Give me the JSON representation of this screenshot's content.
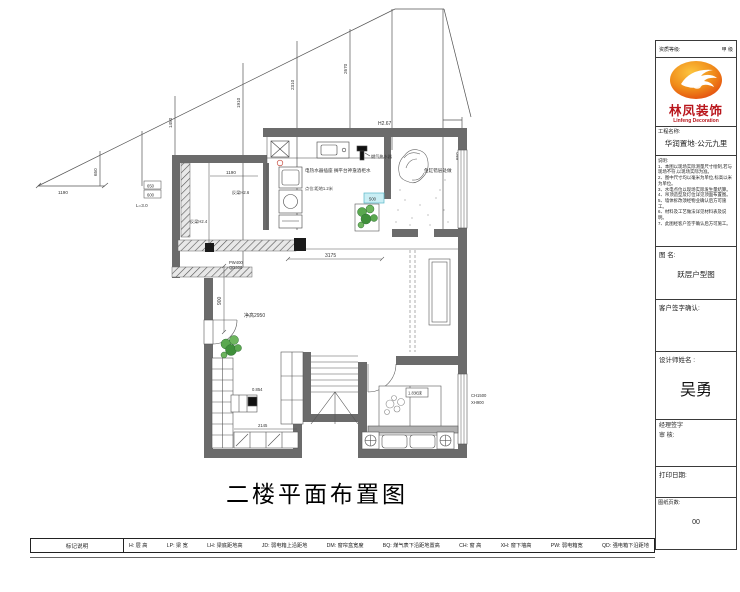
{
  "title": "二楼平面布置图",
  "titleblock": {
    "header_left": "资质等级:",
    "header_right": "甲 级",
    "logo_cn": "林凤装饰",
    "logo_en": "Linfeng Decoration",
    "project_label": "工程名称:",
    "project_name": "华润置地·公元九里",
    "notes_label": "说明:",
    "notes": [
      "1、本图以现场实际测量尺寸绘制,若与现场不符,以现场实际为准。",
      "2、图中尺寸均以毫米为单位,标高以米为单位。",
      "3、水电点位以现场实际发生量结算。",
      "4、吊顶造型及灯位详见顶面布置图。",
      "5、墙体拆改须经物业确认后方可施工。",
      "6、材料及工艺做法详见材料表及说明。",
      "7、此图经客户签字确认后方可施工。"
    ],
    "figname_label": "图 名:",
    "figname_value": "跃层户型图",
    "customer_label": "客户签字确认:",
    "designer_label": "设计师姓名 :",
    "designer_name": "吴勇",
    "manager_line1": "经理签字",
    "manager_line2": "审  核:",
    "print_label": "打印日期:",
    "pages_label": "图纸页数:",
    "pages_value": "00"
  },
  "legend": {
    "title": "标记说明",
    "items": [
      "H: 层  高",
      "LP: 梁  宽",
      "LH: 梁底距地高",
      "JD: 弱电箱上沿距地",
      "DM: 窗帘盒宽度",
      "BQ: 煤气表下沿距地置高",
      "CH: 窗  高",
      "XH: 窗下墙高",
      "PW: 弱电箱宽",
      "QD: 强电箱下沿距地"
    ]
  },
  "plan": {
    "dims": {
      "base": "1190",
      "h1": "650",
      "h2": "1450",
      "h3": "1910",
      "h4": "2310",
      "h5": "2670",
      "h6": "650",
      "apex": "H2.67",
      "room1190": "1190",
      "box650": "650",
      "box600": "600",
      "l30": "L=3.0",
      "beam1": "反梁H2.4",
      "beam2": "反梁H2.6",
      "living_w": "3175",
      "living_h": "900",
      "living_note": "净高2950",
      "pw": "PW400",
      "qd": "QD300",
      "study": "0.854",
      "stair": "2145",
      "bed": "1.8米床",
      "ch": "CH1500",
      "xh": "XH900",
      "cyan": "500"
    },
    "notes": {
      "kitchen": "电热水器插座 搁平台神龛酒柜水",
      "kitchen2": "点位:距地1.2米",
      "gas": "燃气热水器",
      "fish": "鱼缸错层处做"
    }
  }
}
